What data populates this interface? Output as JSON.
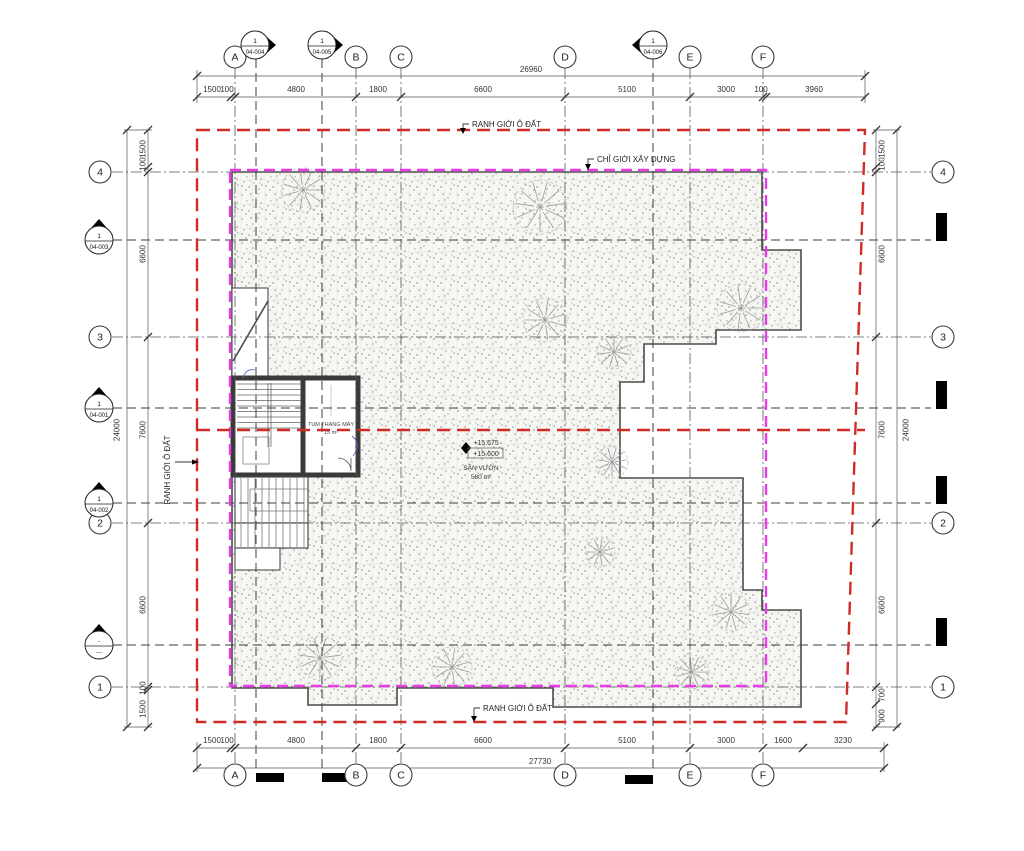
{
  "drawing": {
    "labels": {
      "plot_boundary": "RANH GIỚI Ô ĐẤT",
      "build_limit": "CHỈ GIỚI XÂY DỰNG"
    },
    "core": {
      "label": "TUM THANG MÁY",
      "area": "15 m²"
    },
    "levels": {
      "upper": "+15.675",
      "lower": "+15.600"
    },
    "garden": {
      "name": "SÂN VƯỜN",
      "area": "580 m²"
    },
    "grid": {
      "cols": [
        "A",
        "B",
        "C",
        "D",
        "E",
        "F"
      ],
      "rows": [
        "4",
        "3",
        "2",
        "1"
      ]
    },
    "sections": [
      {
        "num": "1",
        "sheet": "04-004"
      },
      {
        "num": "1",
        "sheet": "04-005"
      },
      {
        "num": "1",
        "sheet": "04-006"
      },
      {
        "num": "1",
        "sheet": "04-003"
      },
      {
        "num": "1",
        "sheet": "04-001"
      },
      {
        "num": "1",
        "sheet": "04-002"
      },
      {
        "num": "-",
        "sheet": "---"
      }
    ],
    "dims": {
      "top": [
        "1500",
        "100",
        "4800",
        "1800",
        "6600",
        "5100",
        "3000",
        "100",
        "3960"
      ],
      "top_total": "26960",
      "bottom": [
        "1500",
        "100",
        "4800",
        "1800",
        "6600",
        "5100",
        "3000",
        "1600",
        "3230"
      ],
      "bottom_total": "27730",
      "left": [
        "1500",
        "100",
        "6600",
        "7600",
        "6600",
        "100",
        "1500"
      ],
      "left_total": "24000",
      "right": [
        "1500",
        "100",
        "6600",
        "7600",
        "6600",
        "700",
        "900"
      ],
      "right_total": "24000"
    },
    "colors": {
      "plot_boundary": "#cf2b27",
      "build_limit": "#e83ce8",
      "outline": "#4b4b4b"
    }
  },
  "plan": {
    "trees": [
      [
        303,
        190,
        22
      ],
      [
        540,
        207,
        27
      ],
      [
        545,
        320,
        22
      ],
      [
        614,
        352,
        17
      ],
      [
        741,
        308,
        24
      ],
      [
        612,
        462,
        16
      ],
      [
        600,
        552,
        15
      ],
      [
        731,
        612,
        19
      ],
      [
        692,
        672,
        17
      ],
      [
        320,
        658,
        22
      ],
      [
        452,
        667,
        20
      ]
    ]
  }
}
